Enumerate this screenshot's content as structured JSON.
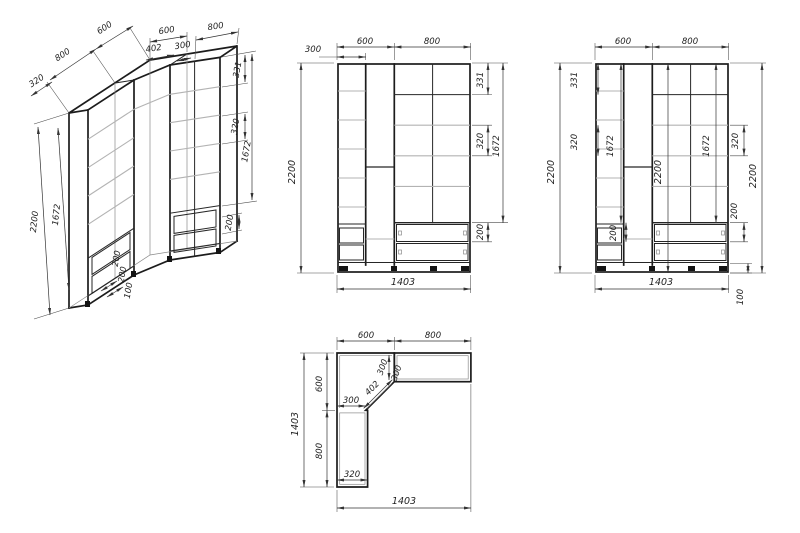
{
  "page": {
    "background": "#ffffff",
    "line_color": "#1c1c1c",
    "shelf_color": "#b3b3b3",
    "dim_color": "#333333"
  },
  "views": {
    "iso": {
      "dims": {
        "left_depth": "800",
        "left_side": "600",
        "corner_top": "600",
        "corner_front": "402",
        "return": "300",
        "right_width": "800",
        "top_section": "331",
        "shelf_pitch": "320",
        "door_height": "1672",
        "drawer": "200",
        "height": "2200",
        "left_shelf": "320",
        "door_inner": "1672",
        "base_a": "200",
        "base_b": "200",
        "base_c": "100"
      }
    },
    "front": {
      "dims": {
        "col": "300",
        "left_width": "600",
        "right_width": "800",
        "height": "2200",
        "top_section": "331",
        "shelf_pitch": "320",
        "door_height": "1672",
        "drawer": "200",
        "width": "1403"
      }
    },
    "front2": {
      "dims": {
        "left_width": "600",
        "right_width": "800",
        "height": "2200",
        "top_section": "331",
        "shelf_pitch": "320",
        "door_left": "1672",
        "drawer_left": "200",
        "height_inner": "2200",
        "door_right": "1672",
        "shelf_right": "320",
        "height_right": "2200",
        "drawer_right": "200",
        "plinth": "100",
        "width": "1403"
      }
    },
    "plan": {
      "dims": {
        "top_left": "600",
        "top_right": "800",
        "side": "1403",
        "corner_side": "600",
        "arm_length": "800",
        "arm_width": "300",
        "corner_front": "402",
        "arm_depth": "300",
        "return_depth": "300",
        "arm_bottom": "320",
        "width": "1403"
      }
    }
  }
}
